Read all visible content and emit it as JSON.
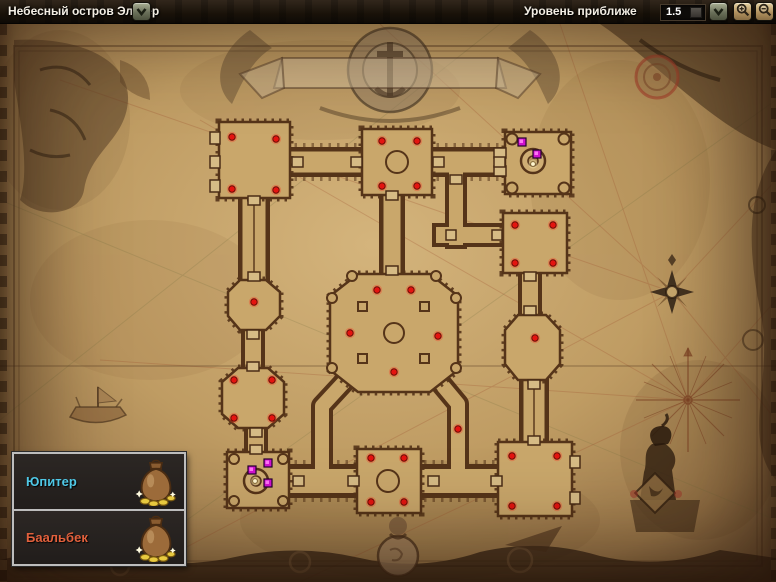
{
  "topbar": {
    "location": {
      "label": "Небесный остров Эльтер",
      "dropdown_icon": "chevron-down"
    },
    "zoom": {
      "label": "Уровень приближе",
      "value": "1.5",
      "dropdown_icon": "chevron-down",
      "buttons": [
        {
          "icon": "zoom-in-magnifier"
        },
        {
          "icon": "zoom-out-magnifier"
        }
      ]
    }
  },
  "legend": {
    "items": [
      {
        "label": "Юпитер",
        "color": "#4fc8e6",
        "icon": "money-bag"
      },
      {
        "label": "Баальбек",
        "color": "#e2603c",
        "icon": "money-bag"
      }
    ]
  },
  "map": {
    "name": "Небесный остров Эльтер",
    "colors": {
      "red_dot": "#e41410",
      "purple_marker": "#cf12cf",
      "white_dot": "#fff6d0",
      "parchment": "#c2a065",
      "wall": "#553419"
    },
    "markers": {
      "red_dots": [
        [
          232,
          137
        ],
        [
          276,
          139
        ],
        [
          232,
          189
        ],
        [
          276,
          190
        ],
        [
          382,
          141
        ],
        [
          417,
          141
        ],
        [
          382,
          186
        ],
        [
          417,
          186
        ],
        [
          515,
          225
        ],
        [
          553,
          225
        ],
        [
          515,
          263
        ],
        [
          553,
          263
        ],
        [
          535,
          338
        ],
        [
          377,
          290
        ],
        [
          411,
          290
        ],
        [
          350,
          333
        ],
        [
          438,
          336
        ],
        [
          394,
          372
        ],
        [
          254,
          302
        ],
        [
          234,
          380
        ],
        [
          272,
          380
        ],
        [
          234,
          418
        ],
        [
          272,
          418
        ],
        [
          458,
          429
        ],
        [
          371,
          458
        ],
        [
          404,
          458
        ],
        [
          371,
          502
        ],
        [
          404,
          502
        ],
        [
          512,
          456
        ],
        [
          557,
          456
        ],
        [
          512,
          506
        ],
        [
          557,
          506
        ]
      ],
      "purple_squares": [
        [
          522,
          142
        ],
        [
          537,
          154
        ],
        [
          268,
          463
        ],
        [
          252,
          470
        ],
        [
          268,
          483
        ]
      ],
      "white_dots": [
        [
          533,
          164
        ],
        [
          255,
          481
        ]
      ]
    }
  }
}
